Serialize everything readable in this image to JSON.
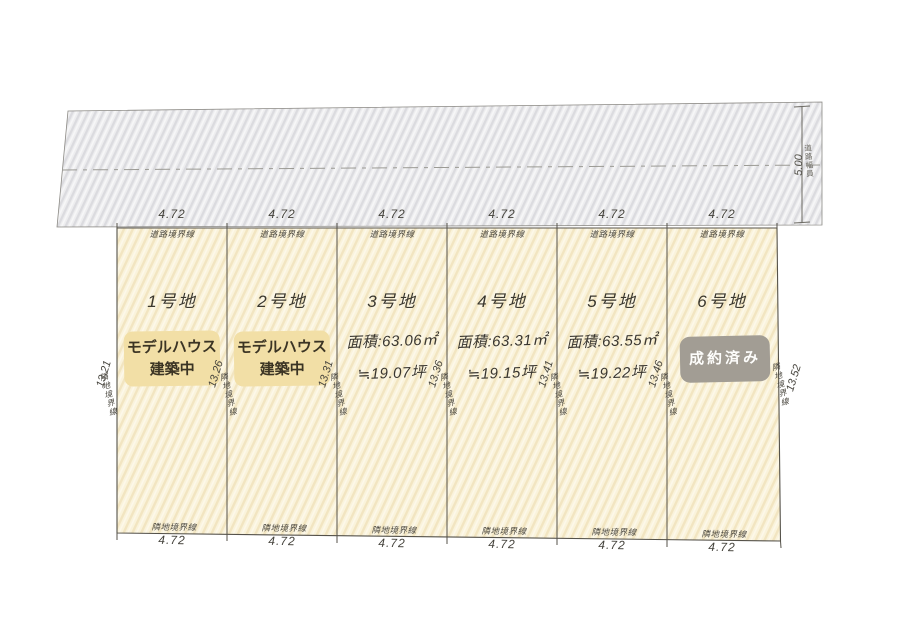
{
  "road": {
    "boundary_label": "道路境界線",
    "width_dim": "5.00",
    "width_label": "道路幅員"
  },
  "side_boundary_label": "隣地境界線",
  "bottom_boundary_label": "隣地境界線",
  "side_dims": [
    "13.21",
    "13.26",
    "13.31",
    "13.36",
    "13.41",
    "13.46",
    "13.52"
  ],
  "plots": [
    {
      "name": "1号地",
      "top_dim": "4.72",
      "bottom_dim": "4.72",
      "badge_line1": "モデルハウス",
      "badge_line2": "建築中"
    },
    {
      "name": "2号地",
      "top_dim": "4.72",
      "bottom_dim": "4.72",
      "badge_line1": "モデルハウス",
      "badge_line2": "建築中"
    },
    {
      "name": "3号地",
      "top_dim": "4.72",
      "bottom_dim": "4.72",
      "area": "面積:63.06㎡",
      "tsubo": "≒19.07坪"
    },
    {
      "name": "4号地",
      "top_dim": "4.72",
      "bottom_dim": "4.72",
      "area": "面積:63.31㎡",
      "tsubo": "≒19.15坪"
    },
    {
      "name": "5号地",
      "top_dim": "4.72",
      "bottom_dim": "4.72",
      "area": "面積:63.55㎡",
      "tsubo": "≒19.22坪"
    },
    {
      "name": "6号地",
      "top_dim": "4.72",
      "bottom_dim": "4.72",
      "sold_label": "成約済み"
    }
  ],
  "colors": {
    "plot_fill": "#faf3db",
    "plot_hatch": "#f2e4c0",
    "road_fill": "#ededef",
    "road_hatch": "#dcdce0",
    "line": "#55524a",
    "badge_model_house_bg": "#f2dfa6",
    "badge_model_house_text": "#3b3424",
    "badge_sold_bg": "#a29d94",
    "badge_sold_text": "#fdfdfb"
  }
}
